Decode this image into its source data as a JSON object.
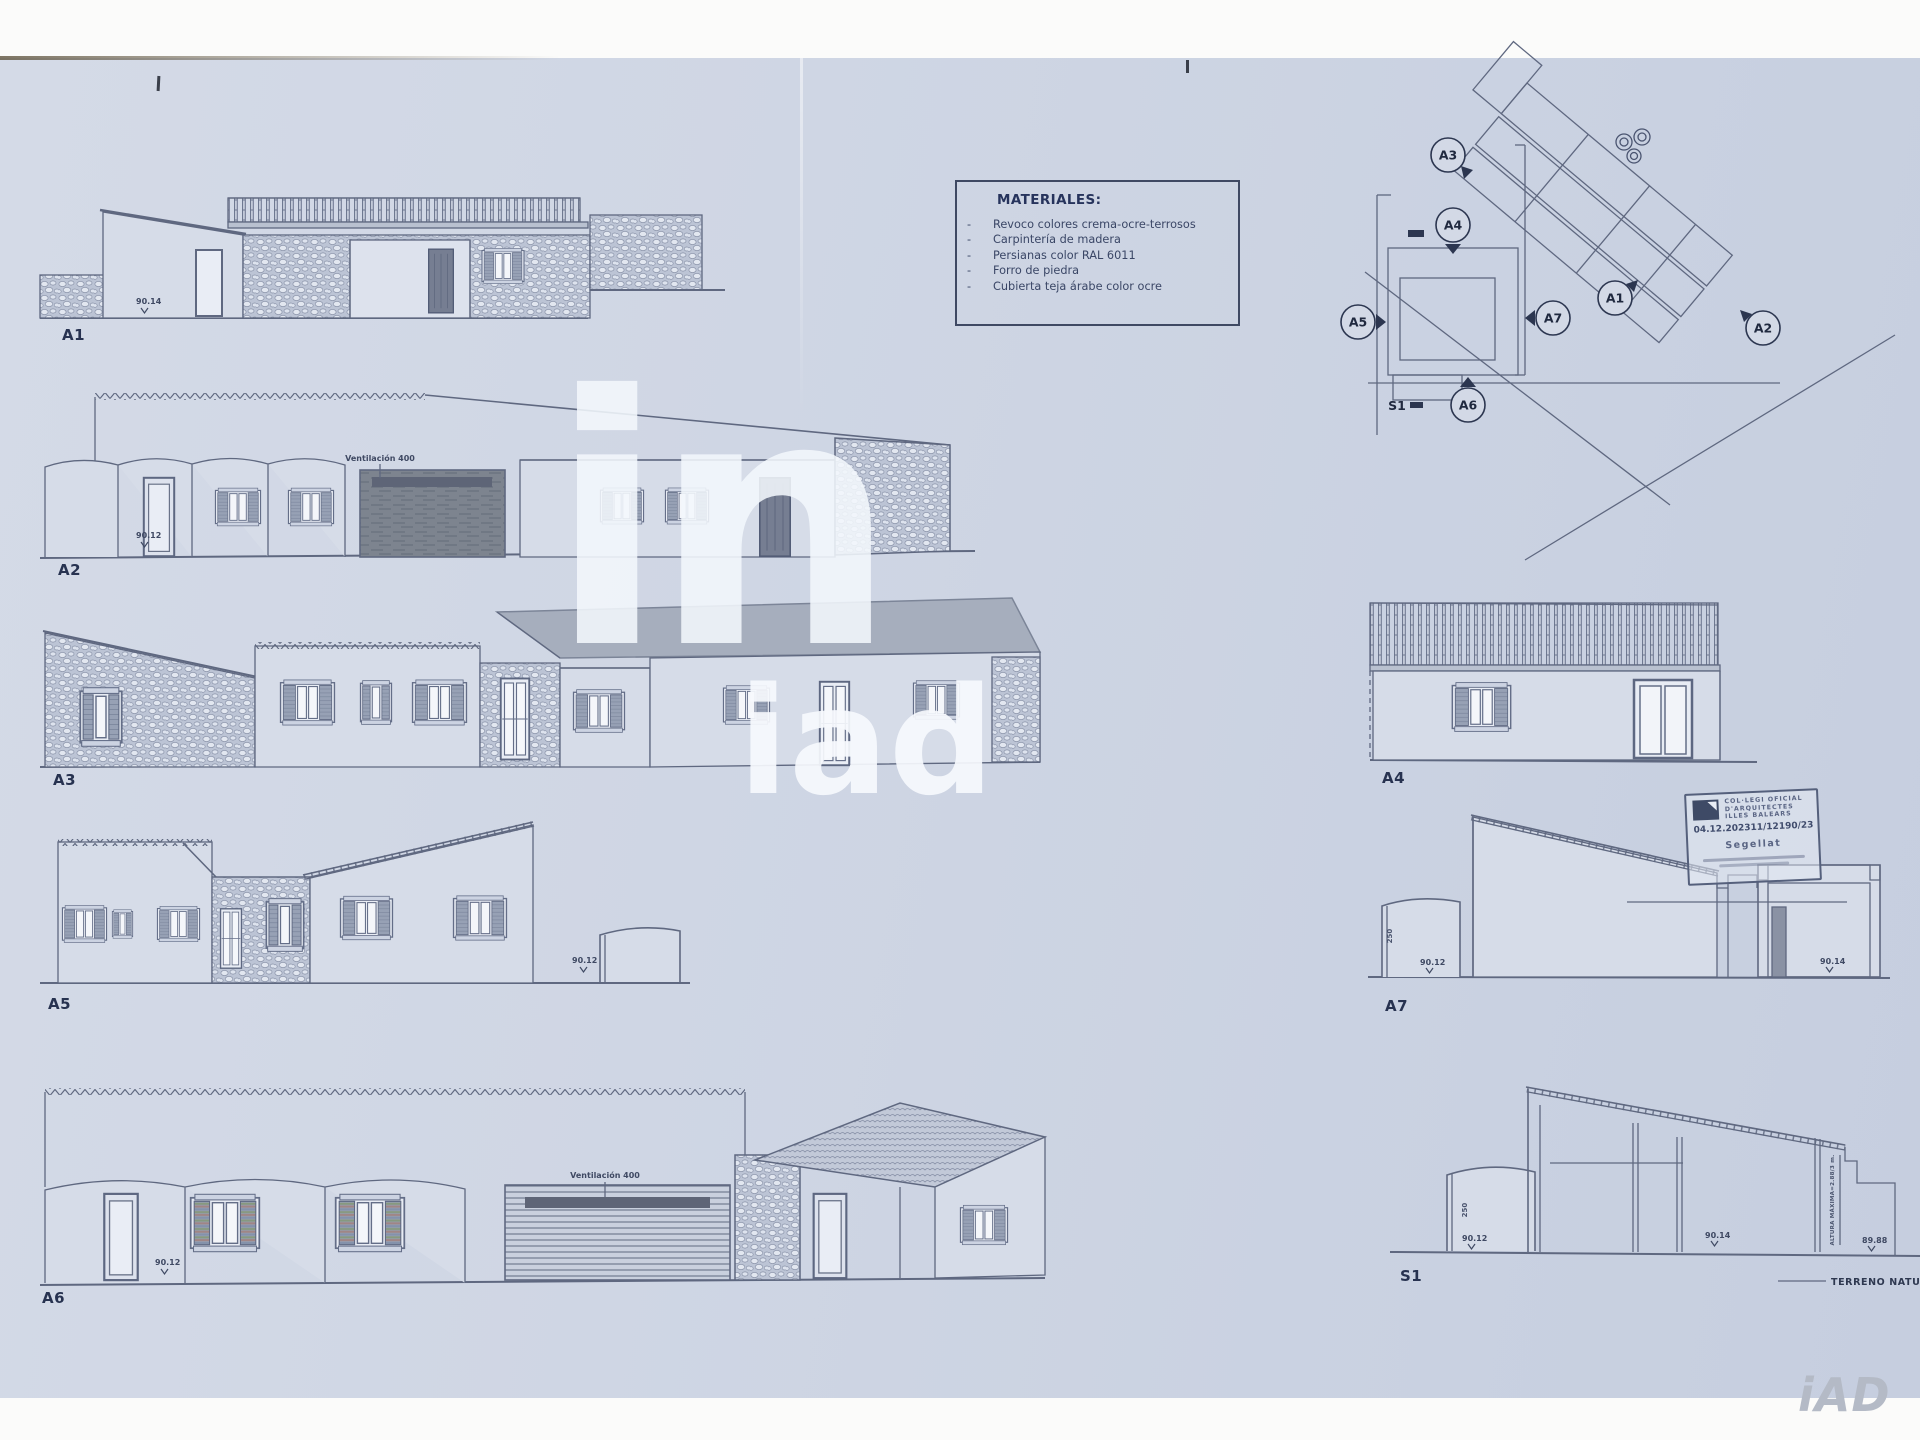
{
  "colors": {
    "paper": "#cfd6e4",
    "ink": "#5f6880",
    "label_ink": "#273250",
    "watermark_white": "#f3f7fc",
    "brand_gray": "#b4bac6",
    "roof_gray": "#a6aebd",
    "garage_dark": "#7d848f"
  },
  "materials": {
    "title": "MATERIALES:",
    "bullet": "-",
    "items": [
      "Revoco colores crema-ocre-terrosos",
      "Carpintería de madera",
      "Persianas color RAL 6011",
      "Forro de piedra",
      "Cubierta teja árabe color ocre"
    ]
  },
  "site_plan": {
    "markers": [
      {
        "id": "A3"
      },
      {
        "id": "A4"
      },
      {
        "id": "A5"
      },
      {
        "id": "A7"
      },
      {
        "id": "A1"
      },
      {
        "id": "A2"
      },
      {
        "id": "A6"
      }
    ],
    "section_label": "S1"
  },
  "elevations": {
    "a1": {
      "label": "A1",
      "dim": "90.14"
    },
    "a2": {
      "label": "A2",
      "dim": "90.12",
      "vent_note": "Ventilación 400"
    },
    "a3": {
      "label": "A3"
    },
    "a4": {
      "label": "A4"
    },
    "a5": {
      "label": "A5",
      "dim": "90.12"
    },
    "a6": {
      "label": "A6",
      "dim": "90.12",
      "vent_note": "Ventilación 400"
    },
    "a7": {
      "label": "A7",
      "dim_left": "90.12",
      "dim_right": "90.14",
      "height_dim": "250"
    },
    "s1": {
      "label": "S1",
      "height_dim": "250",
      "dim_left": "90.12",
      "dim_mid": "90.14",
      "dim_right": "89.88",
      "height_note": "ALTURA MÁXIMA=2.88/3 m.",
      "terrain_label": "TERRENO NATURAL"
    }
  },
  "stamp": {
    "org_line1": "COL·LEGI OFICIAL",
    "org_line2": "D'ARQUITECTES",
    "org_line3": "ILLES BALEARS",
    "date": "04.12.2023",
    "number": "11/12190/23",
    "status": "Segellat"
  },
  "watermark": {
    "glyph": "in",
    "text": "iad"
  },
  "brand": {
    "logo": "iAD"
  }
}
